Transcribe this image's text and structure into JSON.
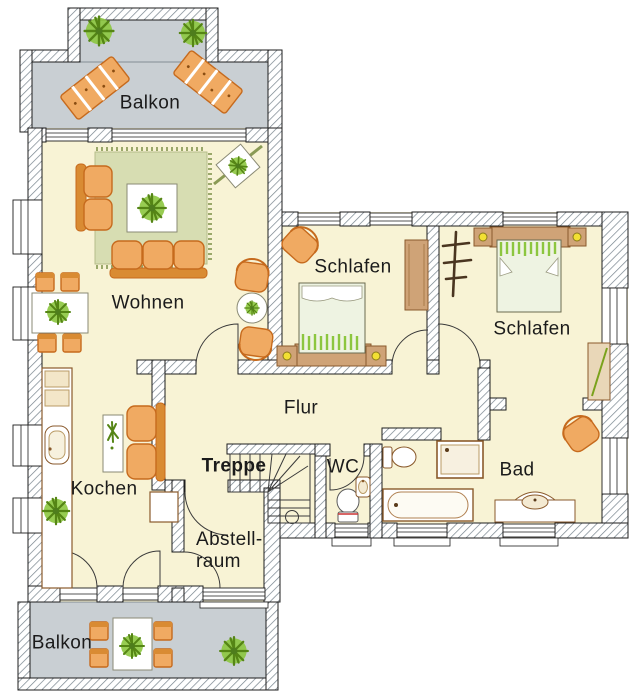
{
  "type": "floor-plan",
  "language": "de",
  "rooms": {
    "balkon_top": {
      "label": "Balkon"
    },
    "wohnen": {
      "label": "Wohnen"
    },
    "schlafen_left": {
      "label": "Schlafen"
    },
    "schlafen_right": {
      "label": "Schlafen"
    },
    "flur": {
      "label": "Flur"
    },
    "treppe": {
      "label": "Treppe"
    },
    "wc": {
      "label": "WC"
    },
    "bad": {
      "label": "Bad"
    },
    "kochen": {
      "label": "Kochen"
    },
    "abstellraum": {
      "line1": "Abstell-",
      "line2": "raum"
    },
    "balkon_bottom": {
      "label": "Balkon"
    }
  },
  "furniture_icons": {
    "balkon_top": [
      "potted-plant-icon",
      "potted-plant-icon",
      "sun-lounger-icon",
      "sun-lounger-icon"
    ],
    "wohnen": [
      "rug-icon",
      "two-seat-sofa-icon",
      "three-seat-sofa-icon",
      "coffee-table-icon",
      "dining-table-icon",
      "dining-chair-icon",
      "round-table-icon",
      "armchair-icon",
      "corner-plant-stand-icon"
    ],
    "kochen": [
      "kitchen-counter-icon",
      "sink-icon",
      "potted-plant-icon",
      "loveseat-icon",
      "shelf-icon",
      "cart-icon"
    ],
    "schlafen_left": [
      "double-bed-icon",
      "nightstand-icon",
      "nightstand-icon",
      "armchair-icon",
      "wardrobe-icon"
    ],
    "schlafen_right": [
      "double-bed-icon",
      "nightstand-icon",
      "nightstand-icon",
      "coat-stand-icon",
      "shelf-icon"
    ],
    "wc": [
      "toilet-icon",
      "hand-basin-icon"
    ],
    "bad": [
      "toilet-icon",
      "shower-icon",
      "bathtub-icon",
      "vanity-sink-icon",
      "armchair-icon"
    ],
    "treppe": [
      "winder-staircase-icon"
    ],
    "balkon_bottom": [
      "garden-table-icon",
      "garden-chair-icon",
      "potted-plant-icon"
    ]
  },
  "colors": {
    "floor": "#f8f3d5",
    "balcony_floor": "#c9cfd3",
    "wall_hatch": "#76838c",
    "wall_outline": "#1d1d1d",
    "rug_green": "#d7ddb2",
    "furniture_orange": "#f0aa62",
    "furniture_orange_dark": "#c66a1d",
    "wood": "#cfa377",
    "plant_green": "#8cc63f",
    "plant_dark": "#558515",
    "lamp_yellow": "#f2e033",
    "label_text": "#1b1b1b"
  }
}
